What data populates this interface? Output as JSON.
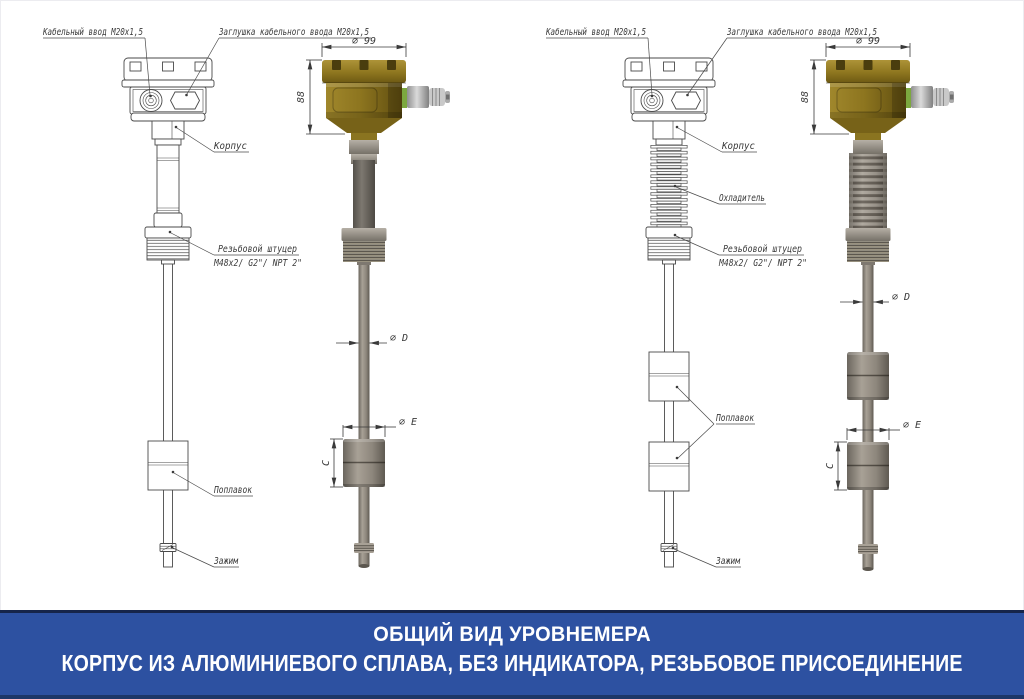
{
  "banner": {
    "title": "ОБЩИЙ ВИД УРОВНЕМЕРА",
    "subtitle": "КОРПУС ИЗ АЛЮМИНИЕВОГО СПЛАВА, БЕЗ ИНДИКАТОРА, РЕЗЬБОВОЕ ПРИСОЕДИНЕНИЕ",
    "background_color": "#2d51a1",
    "text_color": "#ffffff"
  },
  "callouts": {
    "cable_entry": "Кабельный ввод M20x1,5",
    "cable_plug": "Заглушка кабельного ввода M20x1,5",
    "housing": "Корпус",
    "cooler": "Охладитель",
    "thread_fitting_line1": "Резьбовой штуцер",
    "thread_fitting_line2": "M48x2/ G2\"/ NPT 2\"",
    "float": "Поплавок",
    "clamp": "Зажим"
  },
  "dimensions": {
    "head_diameter": "⌀ 99",
    "head_height": "88",
    "probe_diameter": "⌀ D",
    "float_diameter": "⌀ E",
    "float_height": "C"
  },
  "colors": {
    "housing_brass": "#8d751f",
    "metal_grey": "#948d82",
    "drawing_line": "#4a4a4a",
    "banner_blue": "#2d51a1"
  }
}
